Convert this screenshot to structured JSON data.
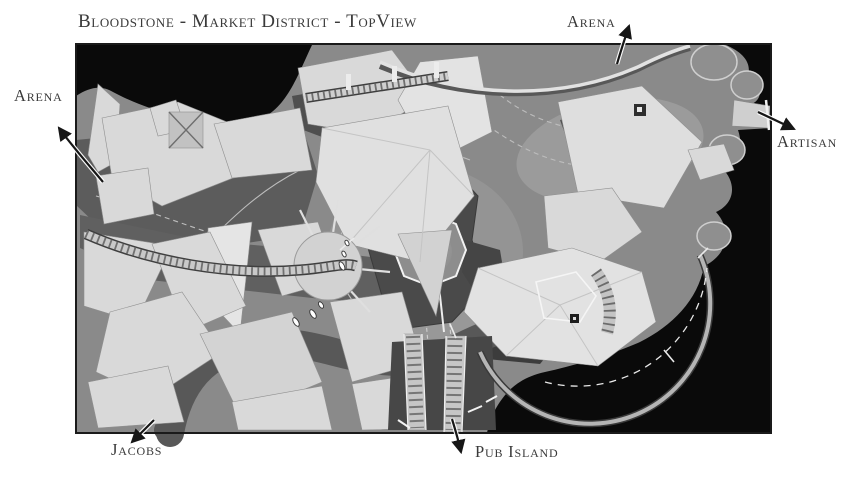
{
  "page": {
    "background": "#ffffff",
    "title": "Bloodstone - Market District - TopView"
  },
  "map": {
    "colors": {
      "canvas": "#0a0a0a",
      "terrain": "#8a8a8a",
      "terrain_light": "#9b9b9b",
      "building": "#d9d9d9",
      "rock": "#4a4a4a",
      "water": "#5c5c5c",
      "bridge": "#cccccc",
      "outline": "#1a1a1a",
      "arrow": "#161616",
      "label_text": "#3a3a3a"
    },
    "labels": {
      "arena_left": "Arena",
      "arena_top": "Arena",
      "artisan": "Artisan",
      "jacobs": "Jacobs",
      "pub_island": "Pub Island"
    },
    "icons": {
      "exit_arrow": "➤"
    }
  }
}
